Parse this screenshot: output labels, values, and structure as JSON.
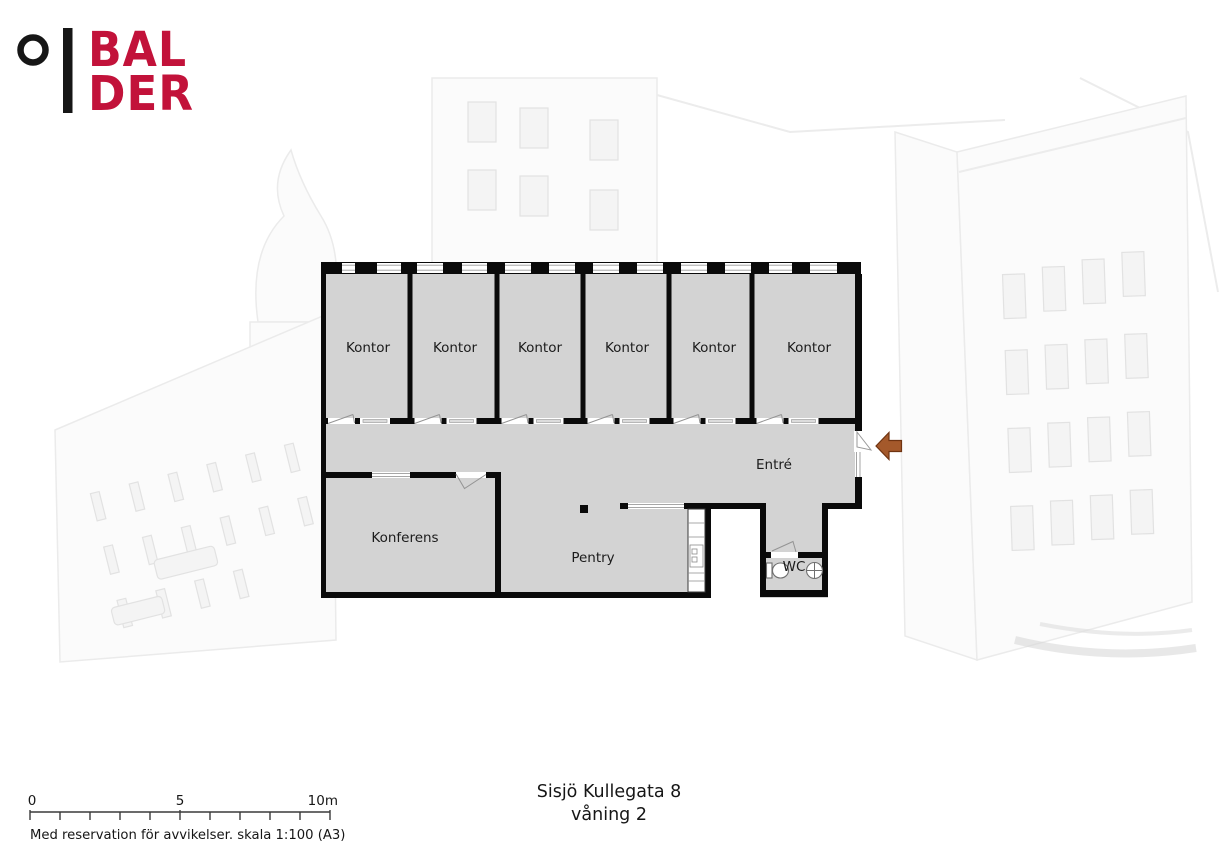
{
  "brand": {
    "line1": "BAL",
    "line2": "DER",
    "color": "#c2123a"
  },
  "floorplan": {
    "rooms": {
      "kontor1": "Kontor",
      "kontor2": "Kontor",
      "kontor3": "Kontor",
      "kontor4": "Kontor",
      "kontor5": "Kontor",
      "kontor6": "Kontor",
      "entre": "Entré",
      "konferens": "Konferens",
      "pentry": "Pentry",
      "wc": "WC"
    },
    "colors": {
      "floor": "#d3d3d3",
      "wall": "#0a0a0a",
      "entry_arrow": "#a4592b"
    }
  },
  "footer": {
    "scale_labels": {
      "zero": "0",
      "five": "5",
      "ten": "10m"
    },
    "disclaimer": "Med reservation för avvikelser. skala 1:100 (A3)",
    "address": "Sisjö Kullegata 8",
    "floor": "våning 2"
  }
}
